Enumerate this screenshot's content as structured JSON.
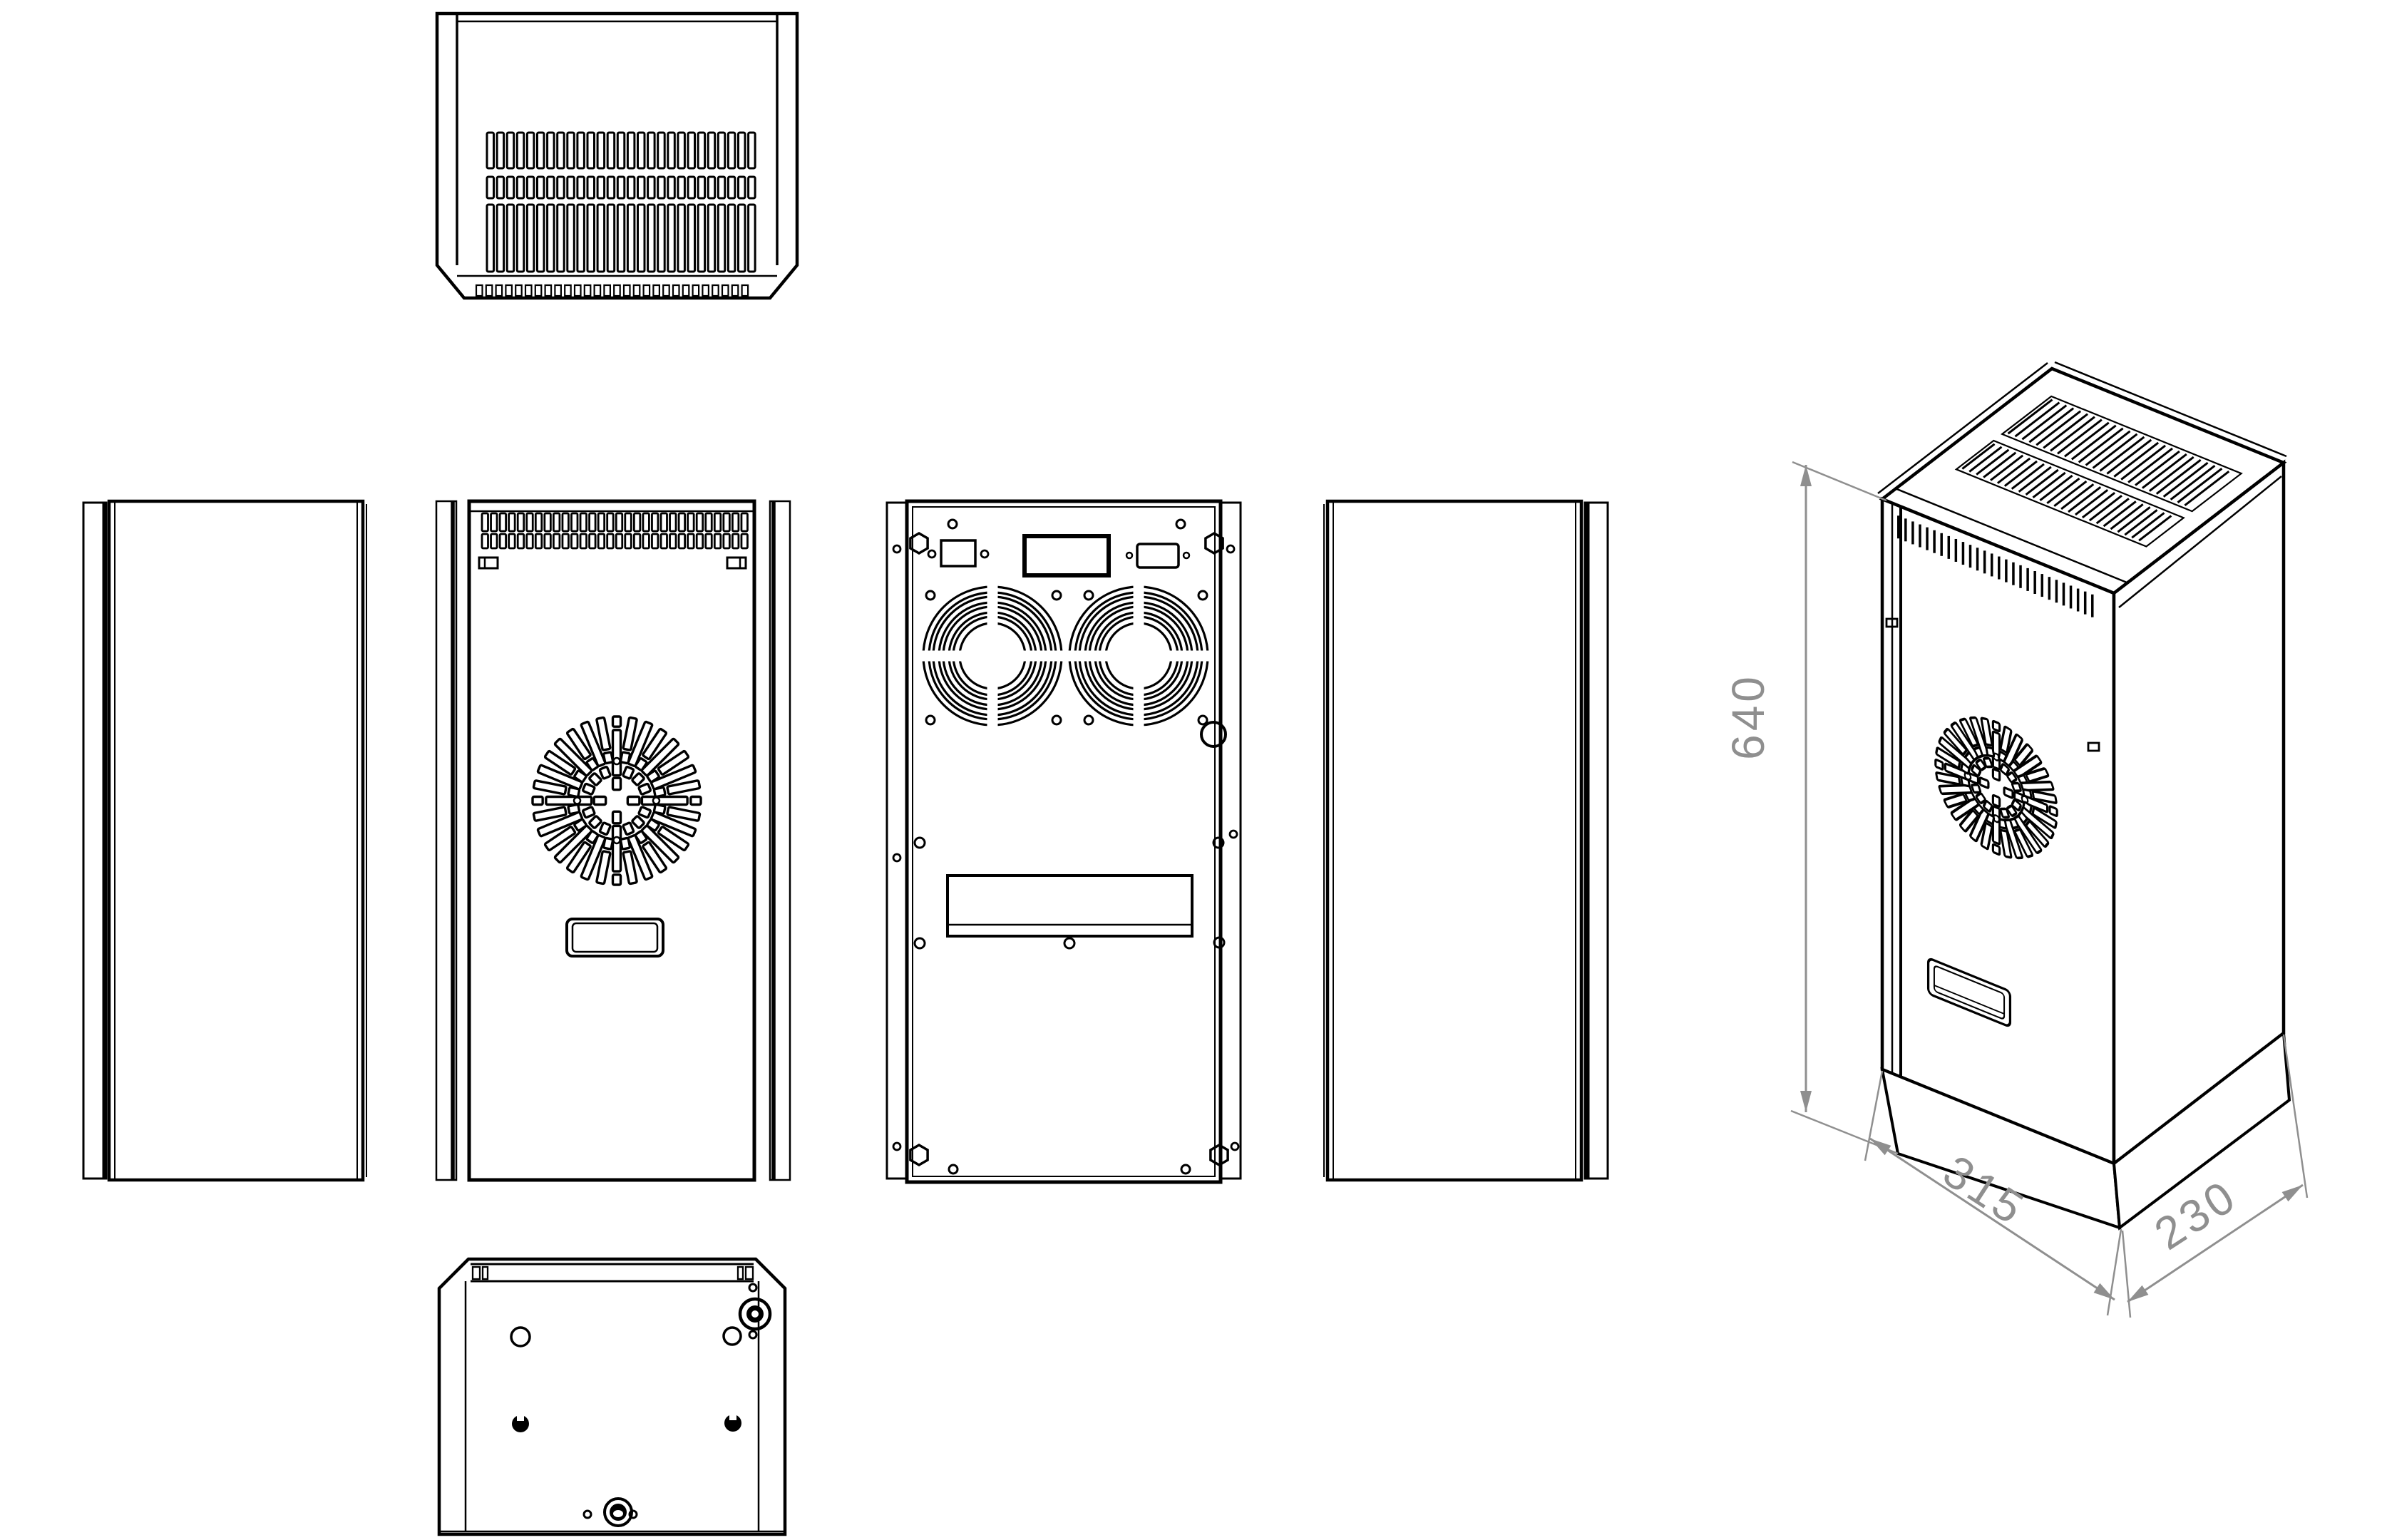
{
  "dimensions": {
    "height": "640",
    "width": "315",
    "depth": "230"
  },
  "colors": {
    "line": "#000000",
    "dimension": "#8f8f8f",
    "background": "#ffffff"
  }
}
